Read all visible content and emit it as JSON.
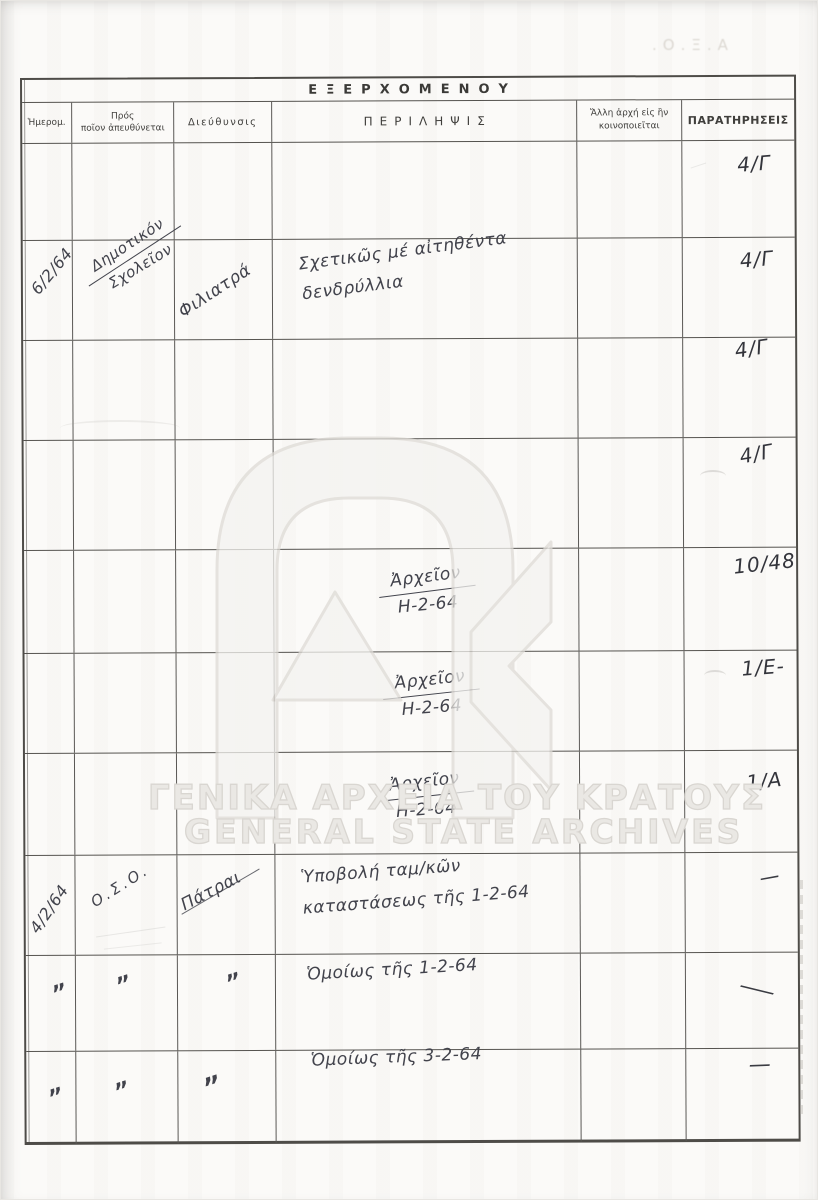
{
  "page": {
    "bleedthrough_top_right": ".Ο.Ξ.Α",
    "watermark_line1": "ΓΕΝΙΚΑ ΑΡΧΕΙΑ ΤΟΥ ΚΡΑΤΟΥΣ",
    "watermark_line2": "GENERAL STATE ARCHIVES"
  },
  "colors": {
    "ink": "#42434c",
    "grid_line": "#54524e",
    "watermark": "#d9d6d1",
    "paper": "#fbfaf8"
  },
  "table": {
    "title": "ΕΞΕΡΧΟΜΕΝΟΥ",
    "columns": [
      "Ἡμερομ.",
      "Πρός\nποῖον ἀπευθύνεται",
      "Διεύθυνσις",
      "ΠΕΡΙΛΗΨΙΣ",
      "Ἄλλη ἀρχή εἰς ἣν\nκοινοποιεῖται",
      "ΠΑΡΑΤΗΡΗΣΕΙΣ"
    ],
    "rows": [
      {
        "remarks": "4/Γ"
      },
      {
        "date": "6/2/64",
        "to": "Δημοτικόν",
        "to2": "Σχολεῖον",
        "address": "Φιλιατρά",
        "summary1": "Σχετικῶς μέ αἰτηθέντα",
        "summary2": "δενδρύλλια",
        "remarks": "4/Γ"
      },
      {
        "remarks": "4/Γ"
      },
      {
        "remarks": "4/Γ"
      },
      {
        "summary1": "Ἀρχεῖον",
        "summary2": "Η-2-64",
        "remarks": "10/48"
      },
      {
        "summary1": "Ἀρχεῖον",
        "summary2": "Η-2-64",
        "remarks": "1/Ε-"
      },
      {
        "summary1": "Ἀρχεῖον",
        "summary2": "Η-2-64",
        "remarks": "1/Α"
      },
      {
        "date": "4/2/64",
        "to": "Ο.Σ.Ο.",
        "address": "Πάτραι",
        "summary1": "Ὑποβολή ταμ/κῶν",
        "summary2": "καταστάσεως τῆς 1-2-64",
        "remarks": "—"
      },
      {
        "date": "„",
        "to": "„",
        "address": "„",
        "summary1": "Ὁμοίως τῆς 1-2-64",
        "remarks": "—"
      },
      {
        "date": "„",
        "to": "„",
        "address": "„",
        "summary1": "Ὁμοίως τῆς 3-2-64",
        "remarks": "—"
      }
    ]
  }
}
